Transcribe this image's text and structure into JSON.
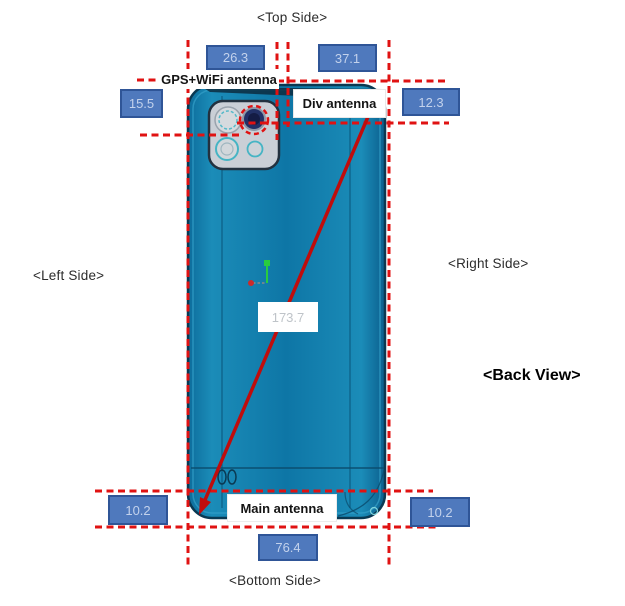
{
  "diagram": {
    "side_labels": {
      "top": "<Top Side>",
      "left": "<Left Side>",
      "right": "<Right Side>",
      "bottom": "<Bottom Side>",
      "back_view": "<Back View>"
    },
    "antenna_labels": {
      "gps_wifi": "GPS+WiFi antenna",
      "div": "Div antenna",
      "main": "Main antenna"
    },
    "measurements": {
      "top_width_left": "26.3",
      "top_width_right": "37.1",
      "left_height_top": "15.5",
      "right_height_top": "12.3",
      "left_height_bottom": "10.2",
      "right_height_bottom": "10.2",
      "bottom_width": "76.4",
      "diagonal": "173.7"
    },
    "colors": {
      "measurement_red": "#e01212",
      "dimension_box_fill": "#4f79bd",
      "dimension_box_border": "#2f5597",
      "dimension_box_text": "#c3d2ec",
      "phone_body_blue": "#0e76a6",
      "phone_edge_dark": "#0a3952",
      "camera_panel_gray": "#cacfd6",
      "axis_green": "#29cc3f"
    }
  }
}
